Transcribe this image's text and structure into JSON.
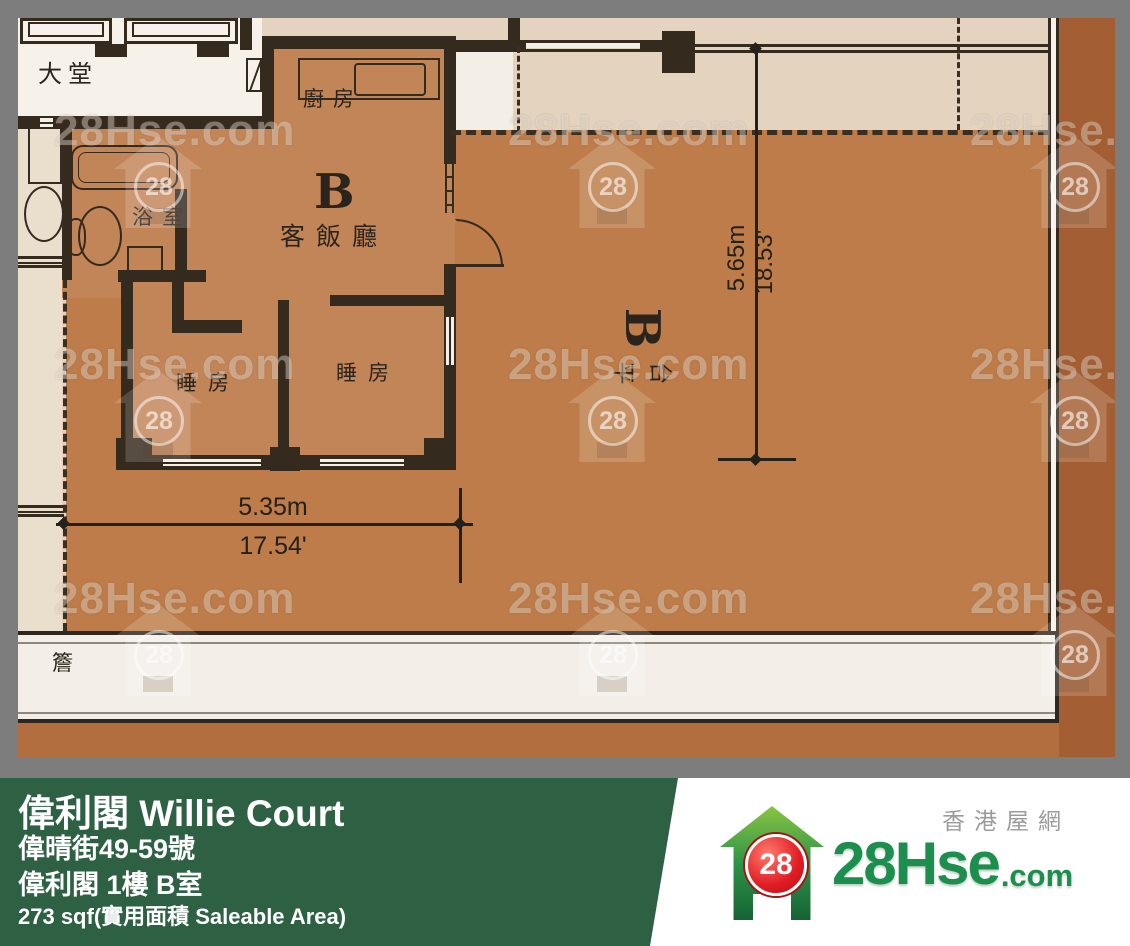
{
  "floor_plan": {
    "labels": {
      "lobby": "大堂",
      "kitchen": "廚房",
      "unit": "B",
      "living_dining": "客飯廳",
      "bathroom": "浴室",
      "bedroom_left": "睡房",
      "bedroom_right": "睡房",
      "terrace_unit": "B",
      "terrace_chars": [
        "平",
        "台"
      ],
      "eave": "簷"
    },
    "dimensions": {
      "width_m": "5.35m",
      "width_ft": "17.54'",
      "depth_m": "5.65m",
      "depth_ft": "18.53'"
    },
    "watermark": {
      "text": "28Hse.com",
      "badge": "28"
    }
  },
  "footer": {
    "building": "偉利閣 Willie Court",
    "address": "偉晴街49-59號",
    "unit": "偉利閣 1樓 B室",
    "area": "273 sqf(實用面積 Saleable Area)",
    "brand": {
      "site_cn": "香港屋網",
      "badge": "28",
      "logo_main": "28Hse",
      "logo_suffix": ".com"
    }
  },
  "colors": {
    "banner_green": "#2e6044",
    "logo_green": "#1c8f4e",
    "logo_red": "#e01c23",
    "unit_fill": "#c28558",
    "terrace_fill": "#bd7c49",
    "common_fill": "#e3d3bf",
    "frame_gray": "#7d7d7d",
    "rust_strip": "#a45e33"
  }
}
